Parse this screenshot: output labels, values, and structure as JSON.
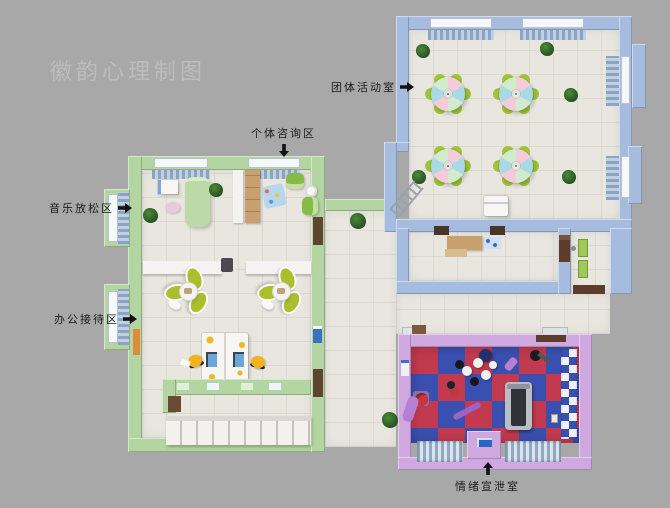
{
  "watermark": {
    "text": "徽韵心理制图"
  },
  "labels": {
    "group_activity_room": {
      "text": "团体活动室",
      "arrow": "right"
    },
    "individual_counseling_area": {
      "text": "个体咨询区",
      "arrow": "down"
    },
    "music_relaxation_area": {
      "text": "音乐放松区",
      "arrow": "right"
    },
    "office_reception_area": {
      "text": "办公接待区",
      "arrow": "right"
    },
    "emotion_venting_room": {
      "text": "情绪宣泄室",
      "arrow": "up"
    }
  },
  "rooms": [
    {
      "name": "团体活动室",
      "wall_color": "#a6bcdf"
    },
    {
      "name": "个体咨询区 · 音乐放松区 · 办公接待区",
      "wall_color": "#b3d5a1"
    },
    {
      "name": "情绪宣泄室",
      "wall_color": "#cfa8e0"
    }
  ],
  "colors": {
    "background": "#a8a8a8",
    "watermark": "#bcbcbc",
    "label_text": "#1c1c1c",
    "green_wall": "#b3d5a1",
    "blue_wall": "#a6bcdf",
    "purple_wall": "#cfa8e0",
    "floor": "#e9e6e0",
    "checker_red": "#c23a4f",
    "checker_blue": "#3a50b0",
    "curtain_blue": "#8ba4c4",
    "lime_chair": "#9fc437",
    "table_pink": "#f3cbd9",
    "table_blue": "#abd8e5",
    "table_green": "#d2eacd",
    "wood": "#c8a06d"
  }
}
